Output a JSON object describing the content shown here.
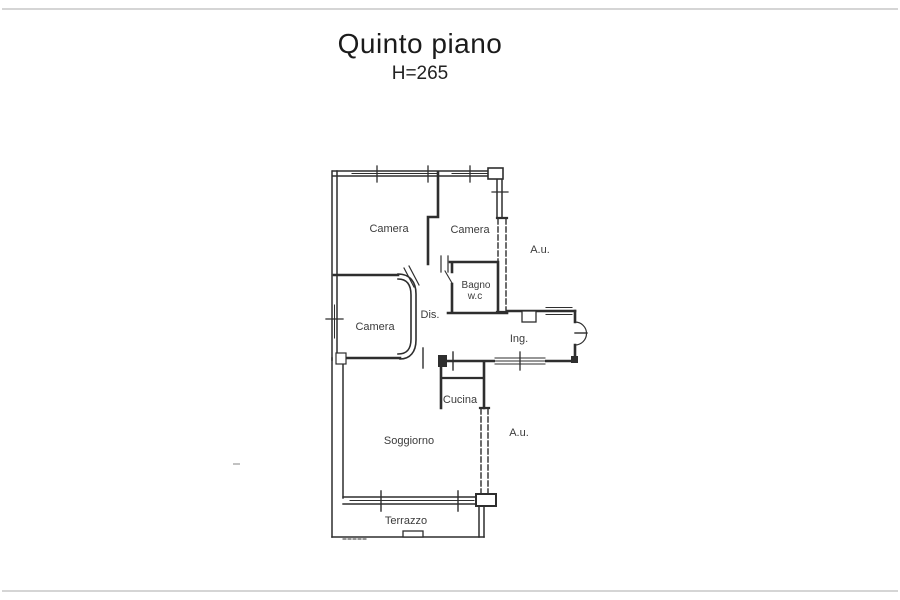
{
  "title": {
    "text": "Quinto piano",
    "subtitle": "H=265"
  },
  "plan": {
    "labels": {
      "camera1": "Camera",
      "camera2": "Camera",
      "camera3": "Camera",
      "bagno_line1": "Bagno",
      "bagno_line2": "w.c",
      "dis": "Dis.",
      "ing": "Ing.",
      "cucina": "Cucina",
      "soggiorno": "Soggiorno",
      "terrazzo": "Terrazzo",
      "au_upper": "A.u.",
      "au_lower": "A.u."
    },
    "ink_color": "#2e2e2e",
    "label_color": "#3b3b3b"
  }
}
